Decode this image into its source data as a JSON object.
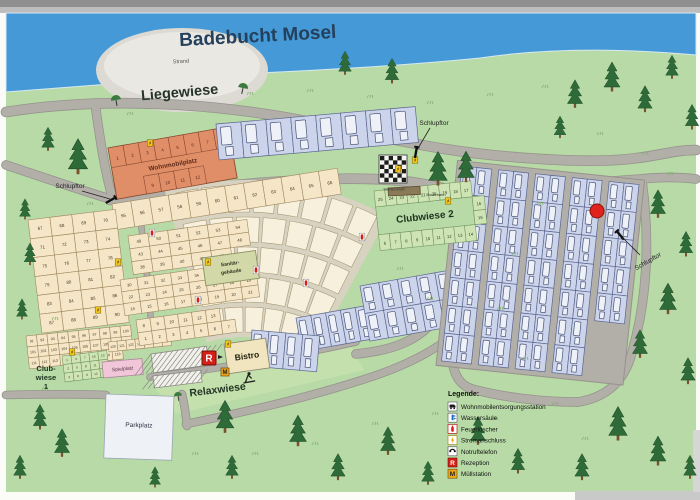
{
  "title": "Badebucht Mosel",
  "labels": {
    "strand": "Strand",
    "liegewiese": "Liegewiese",
    "schlupftor_left": "Schlupftor",
    "schlupftor_top": "Schlupftor",
    "schlupftor_right": "Schlupftor",
    "wohnmobilplatz": "Wohnmobilplatz",
    "clubwiese2": "Clubwiese 2",
    "clubwiese1_line1": "Club-",
    "clubwiese1_line2": "wiese",
    "clubwiese1_line3": "1",
    "sanitaer_line1": "Sanitär-",
    "sanitaer_line2": "gebäude",
    "bistro": "Bistro",
    "relaxwiese": "Relaxwiese",
    "spielplatz": "Spielplatz",
    "parkplatz": "Parkplatz",
    "schachbrett": "Schachbrett",
    "boulebahn": "Boulebahn",
    "reception_letter": "R",
    "muell_letter": "M"
  },
  "legend": {
    "title": "Legende:",
    "items": [
      {
        "icon": "camper-service-icon",
        "label": "Wohnmobilentsorgungsstation"
      },
      {
        "icon": "water-column-icon",
        "label": "Wassersäule"
      },
      {
        "icon": "fire-extinguisher-icon",
        "label": "Feuerlöscher"
      },
      {
        "icon": "power-connection-icon",
        "label": "Stromanschluss"
      },
      {
        "icon": "emergency-phone-icon",
        "label": "Notruftelefon"
      },
      {
        "icon": "reception-icon",
        "label": "Rezeption"
      },
      {
        "icon": "waste-station-icon",
        "label": "Müllstation"
      }
    ]
  },
  "pitches": {
    "wohnmobil_top": [
      1,
      2,
      3,
      4,
      5,
      6,
      7,
      8
    ],
    "wohnmobil_bottom": [
      9,
      10,
      11,
      12
    ],
    "band_55": [
      55,
      56,
      57,
      58,
      59,
      60,
      61,
      62,
      63,
      64,
      65,
      66
    ],
    "left_block": [
      [
        67,
        68,
        69,
        70
      ],
      [
        71,
        72,
        73,
        74
      ],
      [
        75,
        76,
        77,
        78
      ],
      [
        79,
        80,
        81,
        82
      ],
      [
        83,
        84,
        85,
        86
      ],
      [
        87,
        88,
        89,
        90
      ]
    ],
    "left_lower": [
      [
        91,
        92,
        93,
        94,
        95,
        96,
        97,
        98,
        99,
        100
      ],
      [
        101,
        102,
        103,
        104,
        105,
        106,
        107,
        108,
        109,
        110
      ],
      [
        111,
        112,
        113,
        114,
        115,
        116,
        117,
        118,
        119
      ]
    ],
    "left_bottom_strip": [
      120,
      121,
      122,
      123,
      124,
      125,
      126
    ],
    "mid_upper": [
      [
        49,
        50,
        51,
        52,
        53,
        54
      ],
      [
        43,
        44,
        45,
        46,
        47,
        48
      ],
      [
        38,
        39,
        40,
        41,
        42
      ]
    ],
    "mid_block": [
      [
        30,
        31,
        32,
        33,
        34,
        35,
        36,
        37
      ],
      [
        22,
        23,
        24,
        25,
        26,
        27,
        28,
        29
      ],
      [
        14,
        15,
        16,
        17,
        18,
        19,
        20,
        21
      ]
    ],
    "mid_lower": [
      [
        8,
        9,
        10,
        11,
        12,
        13
      ],
      [
        1,
        2,
        3,
        4,
        5,
        6,
        7
      ]
    ],
    "clubwiese2_top": [
      25,
      24,
      23,
      22,
      21,
      20,
      19,
      18,
      17
    ],
    "clubwiese2_right": [
      16,
      15
    ],
    "clubwiese2_bottom": [
      6,
      7,
      8,
      9,
      10,
      11,
      12,
      13,
      14
    ],
    "clubwiese1": [
      [
        1,
        4,
        7,
        10,
        13
      ],
      [
        2,
        5,
        8,
        11,
        14
      ],
      [
        3,
        6,
        9,
        12,
        15
      ]
    ]
  },
  "colors": {
    "water": "#4499d6",
    "meadow": "#b7daa6",
    "road": "#b2afa9",
    "road_edge": "#96938d",
    "pitch_tan": "#f4e6c6",
    "pitch_tan_edge": "#a08860",
    "pitch_lavender": "#cbd4ea",
    "pitch_lavender_edge": "#5c6690",
    "pitch_orange": "#e08e68",
    "pitch_orange_edge": "#8a4a30",
    "pitch_green": "#cfe4b4",
    "pitch_green_edge": "#74965e",
    "fan_cream": "#f7f0dd",
    "fan_edge": "#a89a78",
    "fan_bg": "#d8d2c0",
    "beach_gray": "#dcdad3",
    "spielplatz_pink": "#f0c6d8",
    "parkplatz_white": "#eef1f5",
    "building_khaki": "#d2d8a8",
    "bistro_cream": "#f0e5bf",
    "reception_red": "#d42018",
    "marker_red": "#e0231c",
    "strom_yellow": "#f5c518",
    "waste_yellow": "#f0a818",
    "tree_green": "#2e6b38",
    "title_blue": "#24405c"
  }
}
